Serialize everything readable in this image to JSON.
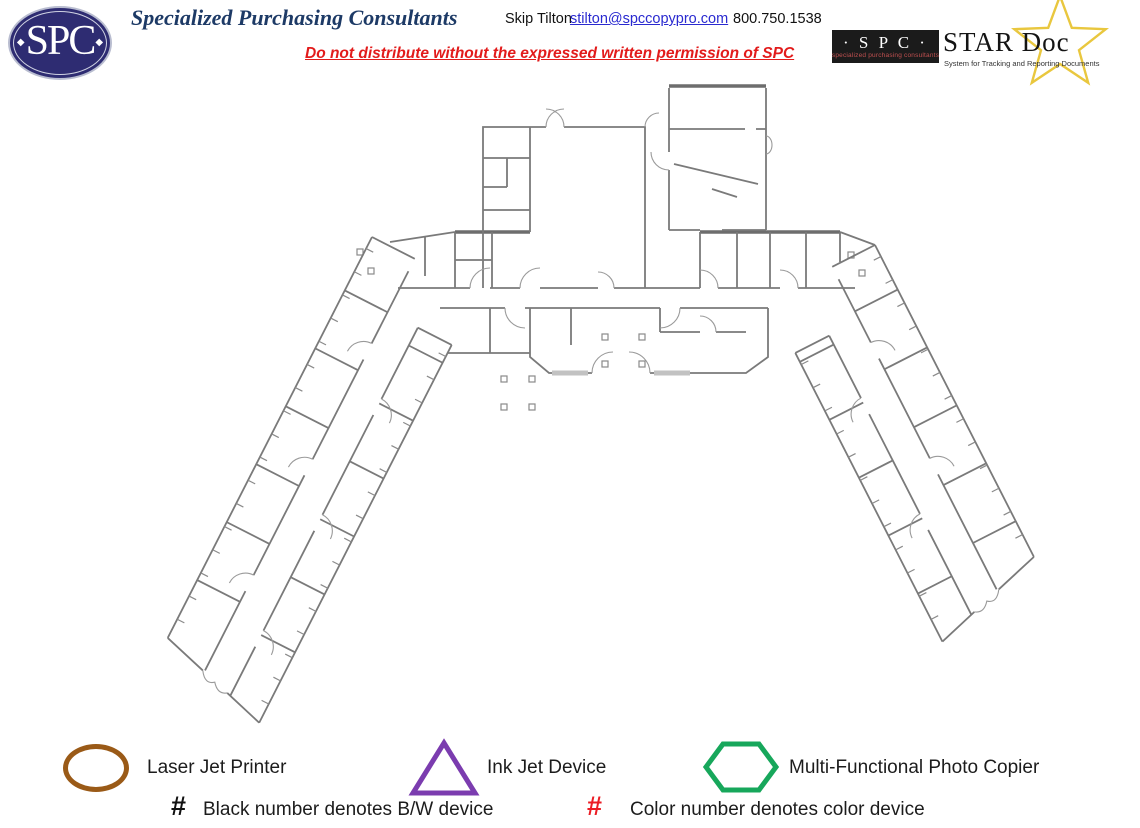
{
  "header": {
    "logo_text": "SPC",
    "logo_diamond": "◆",
    "company_name": "Specialized Purchasing Consultants",
    "contact": {
      "name": "Skip Tilton",
      "email": "stilton@spccopypro.com",
      "phone": "800.750.1538"
    },
    "distribution_notice": "Do not distribute without the expressed written permission of SPC",
    "stardoc": {
      "spc_box_label": "· S P C ·",
      "spc_box_subtext": "specialized purchasing consultants",
      "product_name": "STAR Doc",
      "tagline": "System for Tracking and Reporting Documents",
      "star_color": "#e9c73e"
    }
  },
  "floorplan": {
    "type": "building-floor-plan",
    "wall_color": "#7a7a7a",
    "description": "V-shaped office building: central core with large rooms and entrance lobby, two angled wings with central corridors and offices on both sides"
  },
  "legend": {
    "items": [
      {
        "shape": "ellipse",
        "color": "#9a5a17",
        "label": "Laser Jet Printer"
      },
      {
        "shape": "triangle",
        "color": "#7b3caf",
        "label": "Ink Jet Device"
      },
      {
        "shape": "hexagon",
        "color": "#17a75b",
        "label": "Multi-Functional Photo Copier"
      }
    ],
    "notes": [
      {
        "mark": "#",
        "mark_color": "#111111",
        "label": "Black number denotes B/W device"
      },
      {
        "mark": "#",
        "mark_color": "#ec1c24",
        "label": "Color number denotes color device"
      }
    ]
  }
}
